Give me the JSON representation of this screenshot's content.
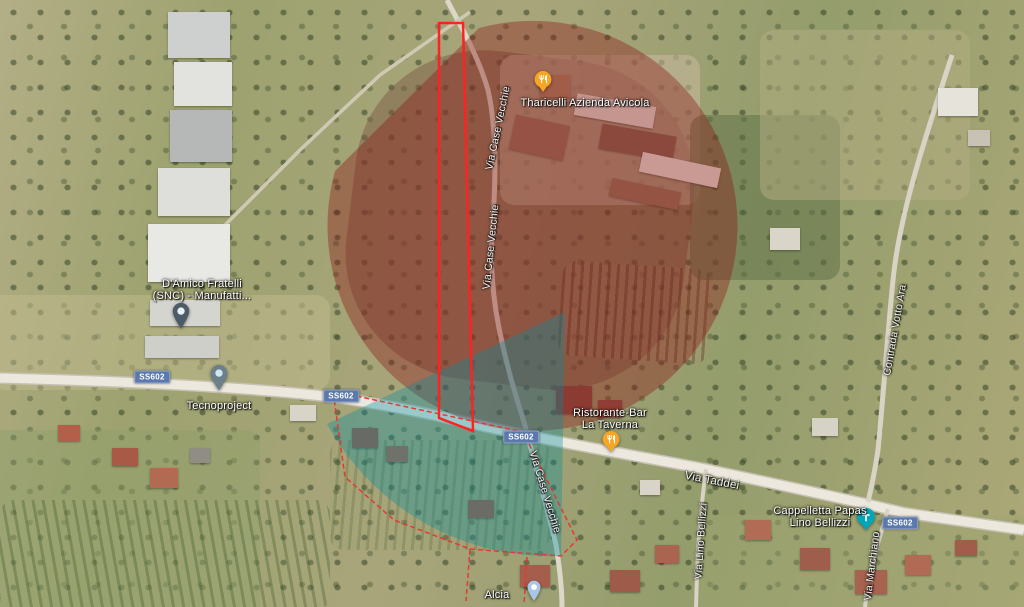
{
  "map": {
    "pois": {
      "faricelli": {
        "label": "Tharicelli Azienda Avicola",
        "marker": "restaurant",
        "color": "#f6a623"
      },
      "damico": {
        "line1": "D'Amico Fratelli",
        "line2": "(SNC) - Manufatti...",
        "color": "#4d5b66"
      },
      "tecnoproject": {
        "label": "Tecnoproject",
        "color": "#6d7f8a"
      },
      "taverna": {
        "line1": "Ristorante-Bar",
        "line2": "La Taverna",
        "marker": "restaurant",
        "color": "#f6a623"
      },
      "cappelletta": {
        "line1": "Cappelletta Papas",
        "line2": "Lino Bellizzi",
        "marker": "chapel",
        "color": "#00a7b8"
      },
      "alcia": {
        "label": "Alcia",
        "color": "#a8c7e8"
      }
    },
    "roads": {
      "shield": "SS602",
      "via_taddei": "Via Taddei",
      "via_case_vecchie": "Via Case Vecchie",
      "contrada_votto_ara": "Contrada Votto Ara",
      "via_lino_bellizzi": "Via Lino Bellizzi",
      "via_marchiano": "Via Marchiano"
    },
    "overlays": {
      "parcel_outline_color": "#ff2222",
      "red_zone_color": "rgba(139,21,21,0.38)",
      "blue_zone_color": "rgba(0,140,160,0.34)",
      "boundary_color": "#e53935",
      "shield_color": "#5b79ad"
    }
  }
}
